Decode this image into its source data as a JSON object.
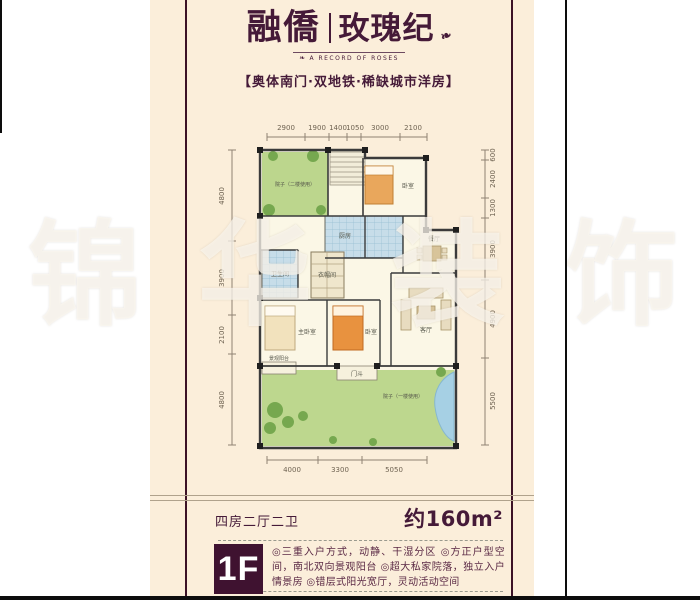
{
  "page": {
    "background": "#ffffff",
    "card_color": "#fbeeda",
    "accent_maroon": "#451a38",
    "badge_bg": "#3f1230"
  },
  "brand": {
    "title_left": "融僑",
    "title_right": "玫瑰纪",
    "tagline": "A RECORD OF ROSES",
    "subtitle": "【奥体南门·双地铁·稀缺城市洋房】"
  },
  "watermark": {
    "char1": "锦",
    "char2": "华",
    "char3": "装",
    "char4": "饰"
  },
  "floorplan": {
    "dims_top": [
      "2900",
      "1900",
      "1400",
      "1050",
      "3000",
      "2100"
    ],
    "dims_bottom": [
      "4000",
      "3300",
      "5050"
    ],
    "dims_left": [
      "4800",
      "3900",
      "2100",
      "4800"
    ],
    "dims_right": [
      "600",
      "2400",
      "1300",
      "3900",
      "4900",
      "5500"
    ],
    "rooms": {
      "courtyard_upper": "院子（二楼使用）",
      "bedroom_top": "卧室",
      "kitchen": "厨房",
      "bathroom": "卫生间",
      "closet": "衣帽间",
      "master_bedroom": "主卧室",
      "bedroom_mid": "卧室",
      "living_room": "客厅",
      "dining_room": "餐厅",
      "foyer": "门斗",
      "balcony": "景观阳台",
      "courtyard_lower": "院子（一楼使用）"
    }
  },
  "specs": {
    "layout": "四房二厅二卫",
    "area": "约160m²"
  },
  "floor_badge": {
    "label": "1F"
  },
  "features": {
    "text": "◎三重入户方式，动静、干湿分区 ◎方正户型空间，南北双向景观阳台 ◎超大私家院落，独立入户情景房 ◎错层式阳光宽厅，灵动活动空间"
  }
}
